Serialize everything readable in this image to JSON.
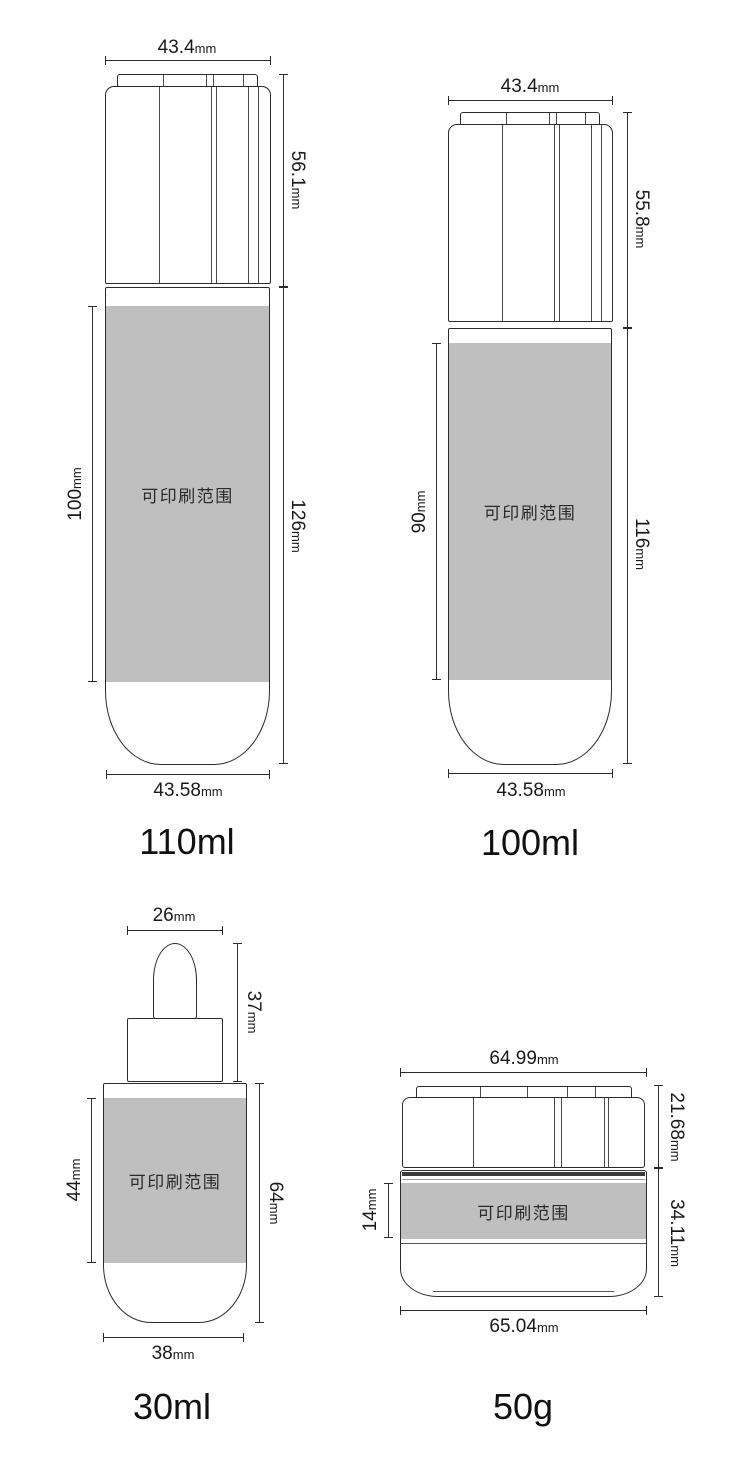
{
  "sheet": {
    "background": "#ffffff",
    "line_color": "#2b2b2b",
    "print_area_fill": "#bfbfbf"
  },
  "products": [
    {
      "id": "bottle-110ml",
      "label": "110ml",
      "print_area_label": "可印刷范围",
      "dims": {
        "cap_width": {
          "value": "43.4",
          "unit": "mm"
        },
        "cap_height": {
          "value": "56.1",
          "unit": "mm"
        },
        "print_height": {
          "value": "100",
          "unit": "mm"
        },
        "body_height": {
          "value": "126",
          "unit": "mm"
        },
        "body_width": {
          "value": "43.58",
          "unit": "mm"
        }
      }
    },
    {
      "id": "bottle-100ml",
      "label": "100ml",
      "print_area_label": "可印刷范围",
      "dims": {
        "cap_width": {
          "value": "43.4",
          "unit": "mm"
        },
        "cap_height": {
          "value": "55.8",
          "unit": "mm"
        },
        "print_height": {
          "value": "90",
          "unit": "mm"
        },
        "body_height": {
          "value": "116",
          "unit": "mm"
        },
        "body_width": {
          "value": "43.58",
          "unit": "mm"
        }
      }
    },
    {
      "id": "dropper-30ml",
      "label": "30ml",
      "print_area_label": "可印刷范围",
      "dims": {
        "dropper_width": {
          "value": "26",
          "unit": "mm"
        },
        "dropper_height": {
          "value": "37",
          "unit": "mm"
        },
        "print_height": {
          "value": "44",
          "unit": "mm"
        },
        "body_height": {
          "value": "64",
          "unit": "mm"
        },
        "body_width": {
          "value": "38",
          "unit": "mm"
        }
      }
    },
    {
      "id": "jar-50g",
      "label": "50g",
      "print_area_label": "可印刷范围",
      "dims": {
        "cap_width": {
          "value": "64.99",
          "unit": "mm"
        },
        "cap_height": {
          "value": "21.68",
          "unit": "mm"
        },
        "print_height": {
          "value": "14",
          "unit": "mm"
        },
        "body_height": {
          "value": "34.11",
          "unit": "mm"
        },
        "body_width": {
          "value": "65.04",
          "unit": "mm"
        }
      }
    }
  ]
}
